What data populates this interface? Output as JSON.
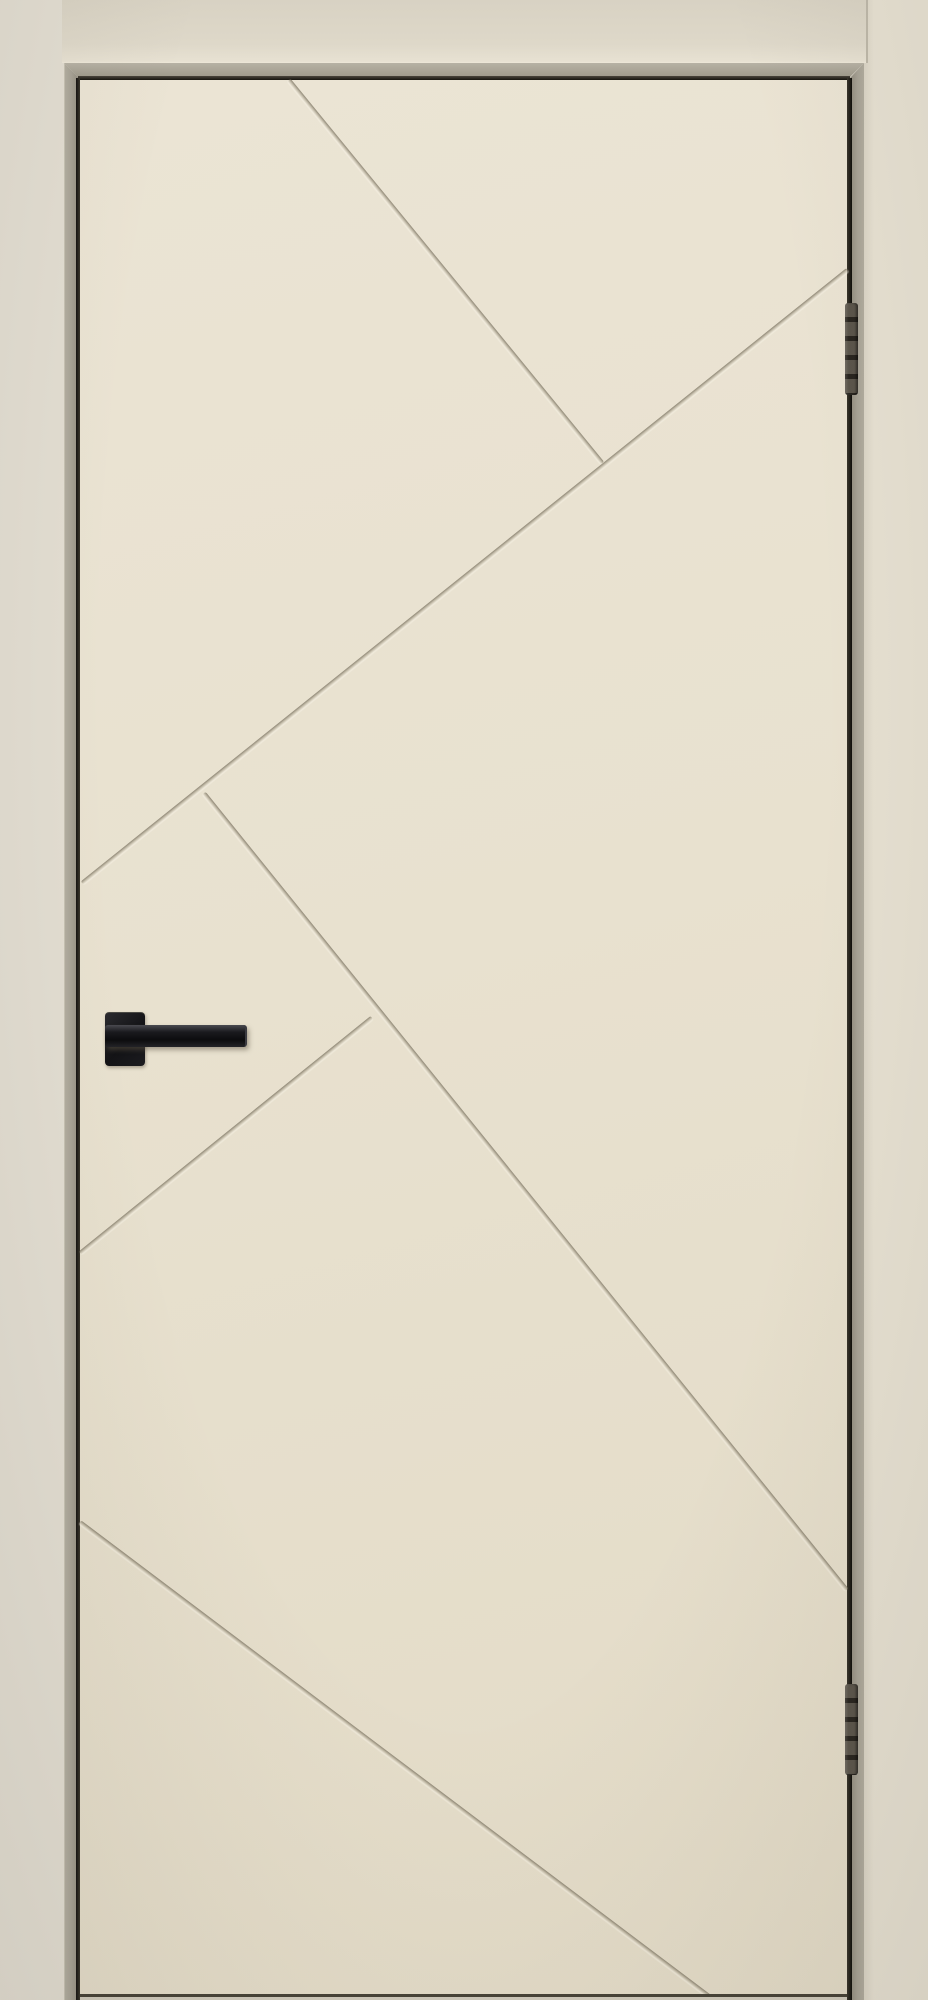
{
  "image": {
    "width": 928,
    "height": 2000,
    "description": "Straight-on product photo of a closed interior door in an ivory/magnolia enamel finish. The flush door leaf is decorated with five recessed diagonal grooves forming an abstract geometric pattern. A black square-rosette lever handle sits on the left side; two dark metal hinges are mortised into the right edge. The door is set in a matching beige casing against a light beige wall."
  },
  "palette": {
    "wall": "#e2ddd1",
    "casing_face": "#e6e0d1",
    "lintel_face": "#ded8c9",
    "frame_bevel": "#a7a295",
    "gap_shadow": "#1a1814",
    "door_leaf": "#e8e1cf",
    "groove_shadow": "#766e5c",
    "handle_black": "#131316",
    "hinge_metal": "#4e483f",
    "threshold": "#cfc9ba"
  },
  "frame": {
    "lintel": {
      "x": 62,
      "y": 0,
      "w": 804,
      "h": 63
    },
    "bevel_top": {
      "x": 64,
      "y": 63,
      "w": 800,
      "h": 15
    },
    "jamb_left": {
      "x": 64,
      "y": 63,
      "w": 14,
      "h": 1937
    },
    "jamb_right": {
      "x": 850,
      "y": 63,
      "w": 14,
      "h": 1937
    },
    "casing_right": {
      "x": 864,
      "y": 0,
      "w": 64,
      "h": 2000
    },
    "gap_top": {
      "x": 78,
      "y": 76,
      "w": 772,
      "h": 4
    },
    "gap_left": {
      "x": 76,
      "y": 78,
      "w": 4,
      "h": 1922
    },
    "gap_right": {
      "x": 847,
      "y": 78,
      "w": 5,
      "h": 1922
    }
  },
  "door": {
    "x": 80,
    "y": 80,
    "w": 767,
    "h": 1914,
    "bottom_edge": {
      "x": 80,
      "y": 1994,
      "w": 767,
      "h": 3
    },
    "threshold": {
      "x": 80,
      "y": 1997,
      "w": 767,
      "h": 3
    },
    "grooves": [
      {
        "name": "main-diagonal",
        "x": 2,
        "y": 803,
        "length": 981,
        "angle": -38.7
      },
      {
        "name": "top-branch",
        "x": 209,
        "y": 0,
        "length": 495,
        "angle": 50.7
      },
      {
        "name": "mid-branch",
        "x": 124,
        "y": 713,
        "length": 1024,
        "angle": 51.1
      },
      {
        "name": "lower-left-branch",
        "x": 0,
        "y": 1173,
        "length": 375,
        "angle": -38.9
      },
      {
        "name": "bottom-diagonal",
        "x": 0,
        "y": 1442,
        "length": 790,
        "angle": 37.0
      }
    ]
  },
  "handle": {
    "side": "left",
    "rosette": {
      "x": 25,
      "y": 932,
      "w": 40,
      "h": 53
    },
    "lever": {
      "x": 25,
      "y": 945,
      "w": 140,
      "h": 22
    }
  },
  "hinges": [
    {
      "name": "hinge-top",
      "x": 845,
      "y": 303,
      "w": 13,
      "h": 92
    },
    {
      "name": "hinge-bottom",
      "x": 845,
      "y": 1684,
      "w": 13,
      "h": 91
    }
  ]
}
